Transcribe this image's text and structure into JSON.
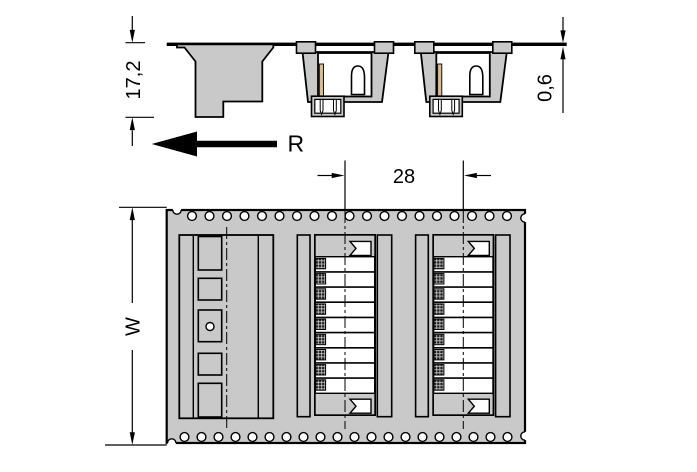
{
  "drawing_title": "Tape-and-reel connector packaging drawing",
  "labels": {
    "height": "17,2",
    "tape_thickness": "0,6",
    "reel_direction": "R",
    "pocket_pitch": "28",
    "tape_width": "W"
  },
  "plan": {
    "sprocket_top": {
      "count": 19,
      "start_x": 192.0,
      "step": 17.5,
      "cy": 216,
      "r": 4.4
    },
    "sprocket_bottom": {
      "count": 20,
      "start_x": 184.5,
      "step": 17.0,
      "cy": 437,
      "r": 4.4
    },
    "connector_centers_x": [
      345,
      463.3
    ],
    "contact_rows": 9
  },
  "side": {
    "connector_centers_x": [
      345,
      463.3
    ]
  },
  "colors": {
    "tape": "#c9c9c9",
    "line": "#000000",
    "contact_strip": "#d9bb90",
    "contact_pad": "#1a1a1a",
    "background": "#ffffff"
  }
}
